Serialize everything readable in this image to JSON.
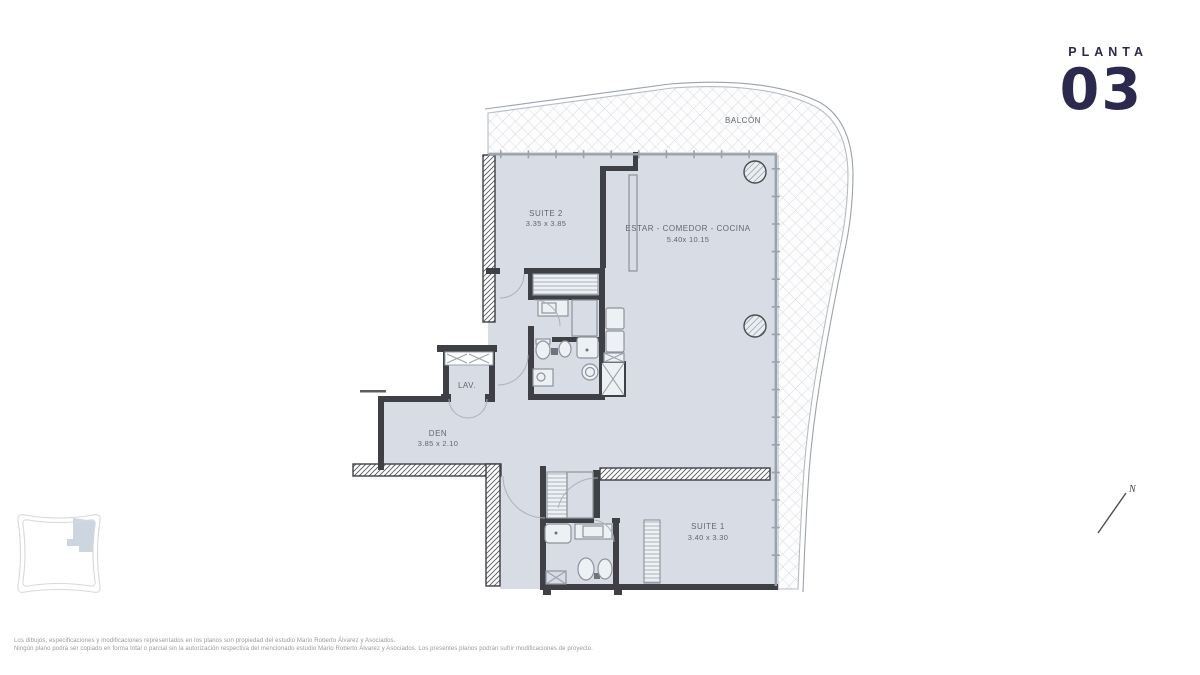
{
  "header": {
    "label": "PLANTA",
    "number": "03"
  },
  "plan": {
    "balcony": {
      "name": "BALCÓN"
    },
    "suite2": {
      "name": "SUITE 2",
      "dims": "3.35 x 3.85"
    },
    "living": {
      "name": "ESTAR - COMEDOR - COCINA",
      "dims": "5.40x 10.15"
    },
    "lav": {
      "name": "LAV."
    },
    "den": {
      "name": "DEN",
      "dims": "3.85 x 2.10"
    },
    "suite1": {
      "name": "SUITE 1",
      "dims": "3.40 x 3.30"
    }
  },
  "compass": {
    "label": "N"
  },
  "footer": {
    "line1": "Los dibujos, especificaciones y modificaciones representados en los planos son propiedad del estudio Mario Roberto Álvarez y Asociados.",
    "line2": "Ningún plano podrá ser copiado en forma total o parcial sin la autorización respectiva del mencionado estudio Mario Roberto Álvarez y Asociados. Los presentes planos podrán sufrir modificaciones de proyecto."
  },
  "colors": {
    "navy": "#2b2a4e",
    "floor": "#d8dde5",
    "wall": "#3f4045",
    "line": "#9aa2ac",
    "text": "#63676e",
    "muted": "#96999e",
    "hatch": "#ccd1d8",
    "patch": "#cdd5e0"
  }
}
